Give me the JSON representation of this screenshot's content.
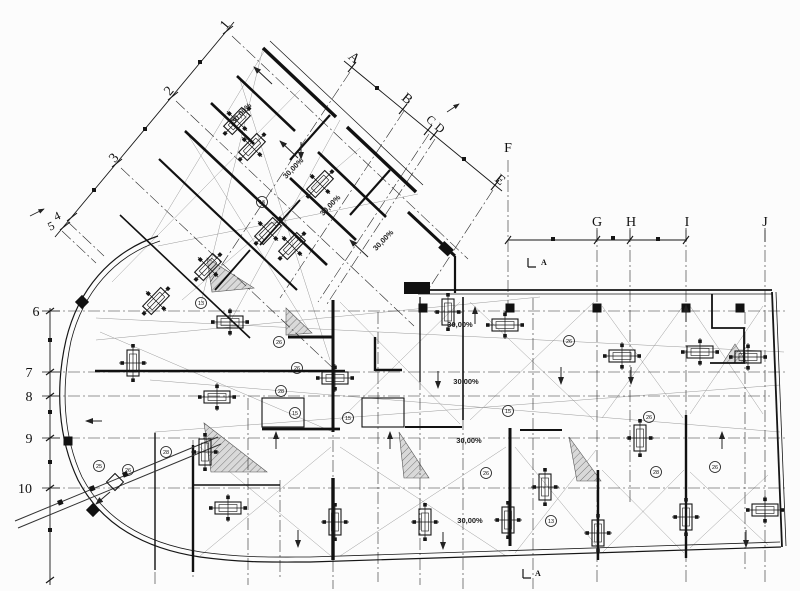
{
  "drawing": {
    "type": "architectural-floor-plan",
    "background": "#fcfcfc",
    "line_color": "#1c1c1c",
    "slope_label": "30,00%",
    "grid": {
      "diagonal_numbers": [
        "1",
        "2",
        "3",
        "4",
        "5"
      ],
      "diagonal_letters": [
        "A",
        "B",
        "C",
        "D",
        "E"
      ],
      "column_letters": [
        "F",
        "G",
        "H",
        "I",
        "J"
      ],
      "row_numbers": [
        "6",
        "7",
        "8",
        "9",
        "10"
      ]
    },
    "position_markers": [
      "16",
      "13",
      "25",
      "26",
      "28",
      "26",
      "26",
      "28",
      "15",
      "15",
      "15",
      "26",
      "26",
      "26",
      "28",
      "26",
      "13"
    ],
    "section_markers": {
      "top": "A",
      "bottom": "A"
    }
  }
}
